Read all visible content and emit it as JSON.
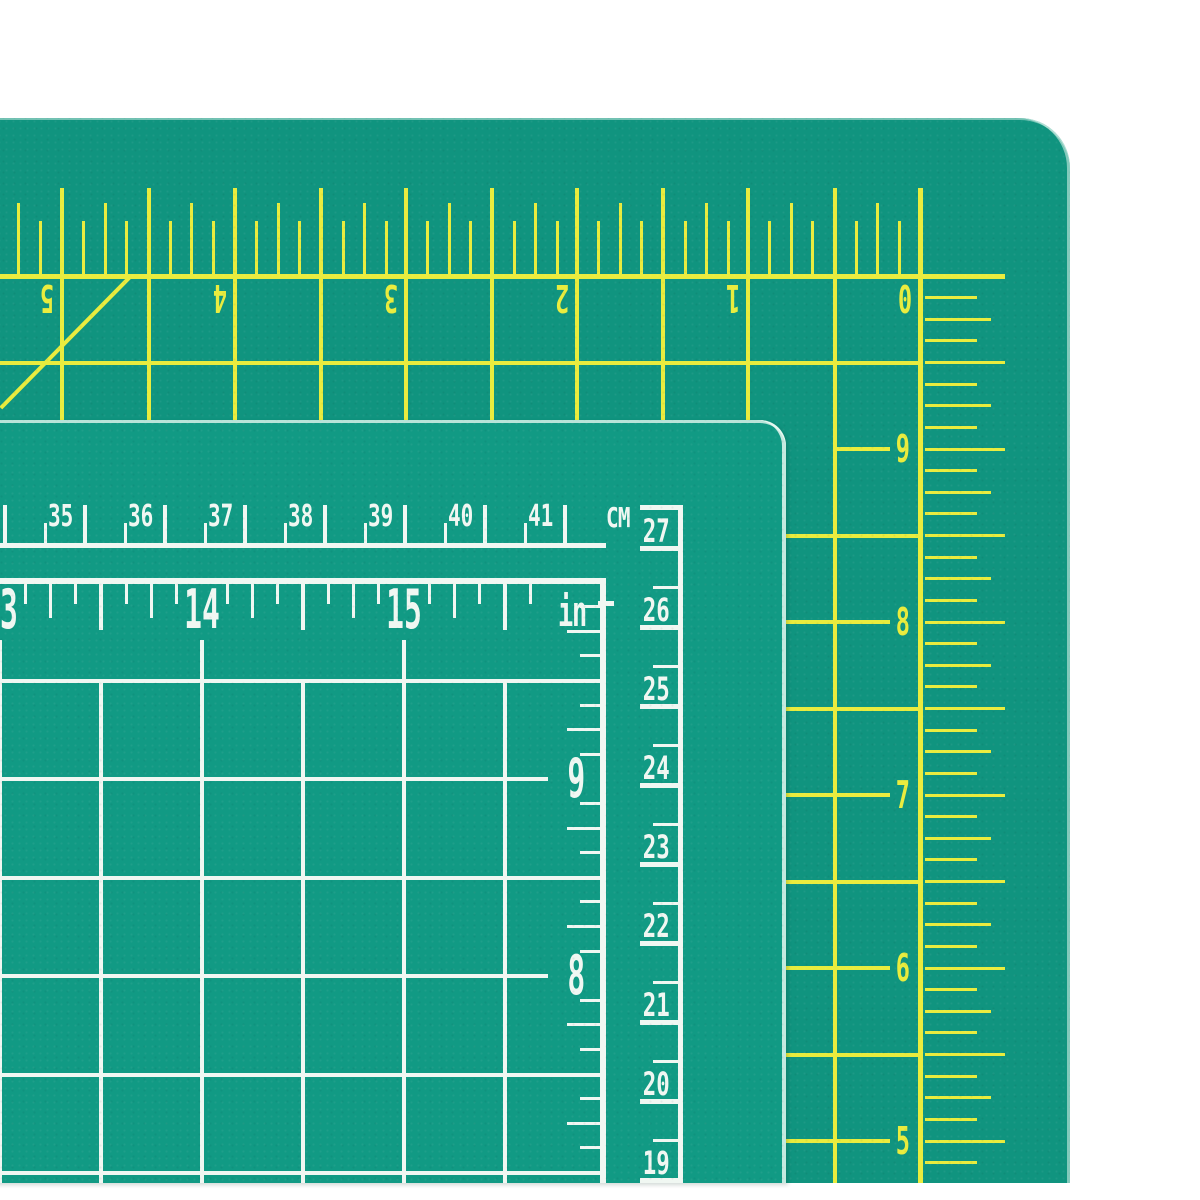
{
  "scene": {
    "description": "Two green self-healing craft cutting mats overlapping on a white background; a large mat with yellow markings behind and a smaller mat with white markings in front",
    "background_color": "#ffffff"
  },
  "large_mat": {
    "surface_color": "#10947f",
    "marking_color": "#e9ec3e",
    "grid": "0.5 inch squares with 1/8 inch tick marks",
    "corner": "rounded top-right corner with 45-degree bias line near the 5 mark",
    "top_ruler": {
      "unit": "inches",
      "orientation": "upside-down",
      "labels": [
        "5",
        "4",
        "3",
        "2",
        "1",
        "0"
      ]
    },
    "right_ruler": {
      "unit": "inches",
      "labels": [
        "9",
        "8",
        "7",
        "6",
        "5"
      ]
    }
  },
  "small_mat": {
    "surface_color": "#119a84",
    "marking_color": "#f0f7f2",
    "grid": "0.5 inch squares",
    "cm_ruler": {
      "unit_label": "CM",
      "labels": [
        "35",
        "36",
        "37",
        "38",
        "39",
        "40",
        "41"
      ]
    },
    "inch_ruler": {
      "unit_label": "in",
      "labels": [
        "13",
        "14",
        "15"
      ]
    },
    "right_cm_ruler": {
      "labels": [
        "27",
        "26",
        "25",
        "24",
        "23",
        "22",
        "21",
        "20",
        "19"
      ]
    },
    "inner_inch_ruler": {
      "labels": [
        "9",
        "8"
      ]
    }
  }
}
